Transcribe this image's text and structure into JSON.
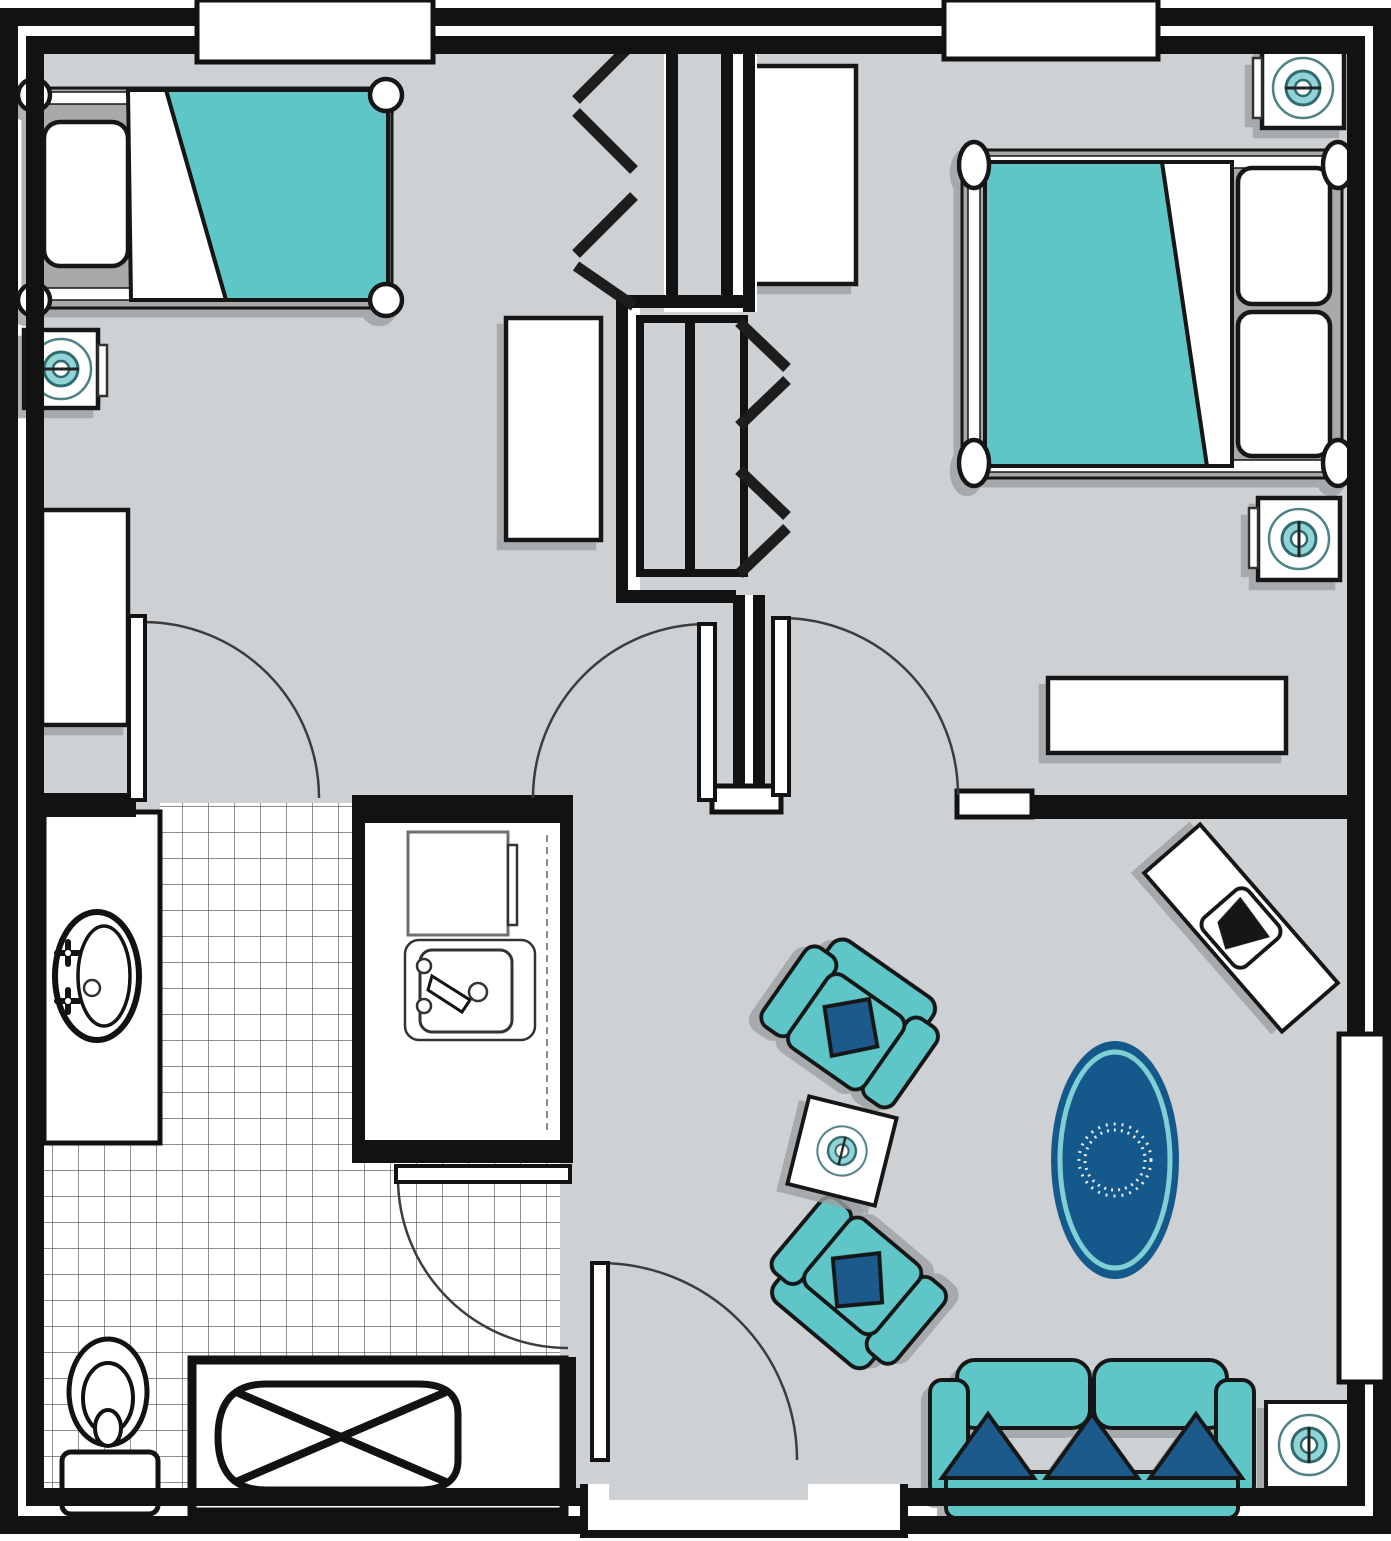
{
  "document": {
    "type": "floor-plan",
    "title": "Residential suite floor plan",
    "visible_text": [],
    "rooms": [
      {
        "name": "bedroom-1",
        "position": "top-left",
        "furniture": [
          "twin-bed-teal-blanket",
          "nightstand-with-lamp",
          "tall-dresser",
          "closet-dresser",
          "bifold-closet"
        ]
      },
      {
        "name": "bedroom-2",
        "position": "top-right",
        "furniture": [
          "double-bed-teal-blanket-two-pillows",
          "nightstand-with-lamp-top",
          "nightstand-with-lamp-bottom",
          "dresser",
          "console-bench",
          "bifold-closet"
        ]
      },
      {
        "name": "bathroom",
        "position": "bottom-left",
        "floor": "tile-grid",
        "furniture": [
          "vanity-with-oval-sink",
          "toilet",
          "bathtub-with-x"
        ]
      },
      {
        "name": "kitchenette",
        "position": "center-left",
        "furniture": [
          "refrigerator",
          "kitchen-sink",
          "counter"
        ]
      },
      {
        "name": "living-room",
        "position": "bottom-right",
        "furniture": [
          "sofa-three-navy-pillows",
          "armchair-upper",
          "armchair-lower",
          "square-side-table-tilted",
          "square-side-table-right",
          "oval-area-rug",
          "tilted-desk-with-chair"
        ]
      },
      {
        "name": "entry-porch",
        "position": "bottom-center"
      }
    ],
    "doors": [
      {
        "name": "bedroom-1-door",
        "type": "swing"
      },
      {
        "name": "hall-left-door",
        "type": "swing"
      },
      {
        "name": "bedroom-2-door",
        "type": "swing"
      },
      {
        "name": "bathroom-door",
        "type": "swing"
      },
      {
        "name": "entry-door",
        "type": "swing"
      },
      {
        "name": "closet-1-door",
        "type": "bifold-chevron"
      },
      {
        "name": "closet-2-door",
        "type": "bifold-chevron"
      }
    ],
    "windows": [
      {
        "name": "window-top-left"
      },
      {
        "name": "window-top-right"
      },
      {
        "name": "window-right-wall"
      }
    ],
    "counts": {
      "sofa_pillows": 3,
      "armchairs": 2,
      "beds": 2,
      "nightstand_lamps": 5
    }
  },
  "colors": {
    "floor": "#ced1d3",
    "ink": "#121212",
    "teal": "#5ec6c7",
    "teal_light": "#92d4d5",
    "navy": "#1d5a8b",
    "rug": "#15598c",
    "rug_ring": "#7fcfd3",
    "ring": "#4e8286",
    "ring_dark": "#2f6b6e",
    "arc": "#3c3c3c",
    "tile_line": "#4b4b4b",
    "shadow": "#9ca0a2"
  }
}
